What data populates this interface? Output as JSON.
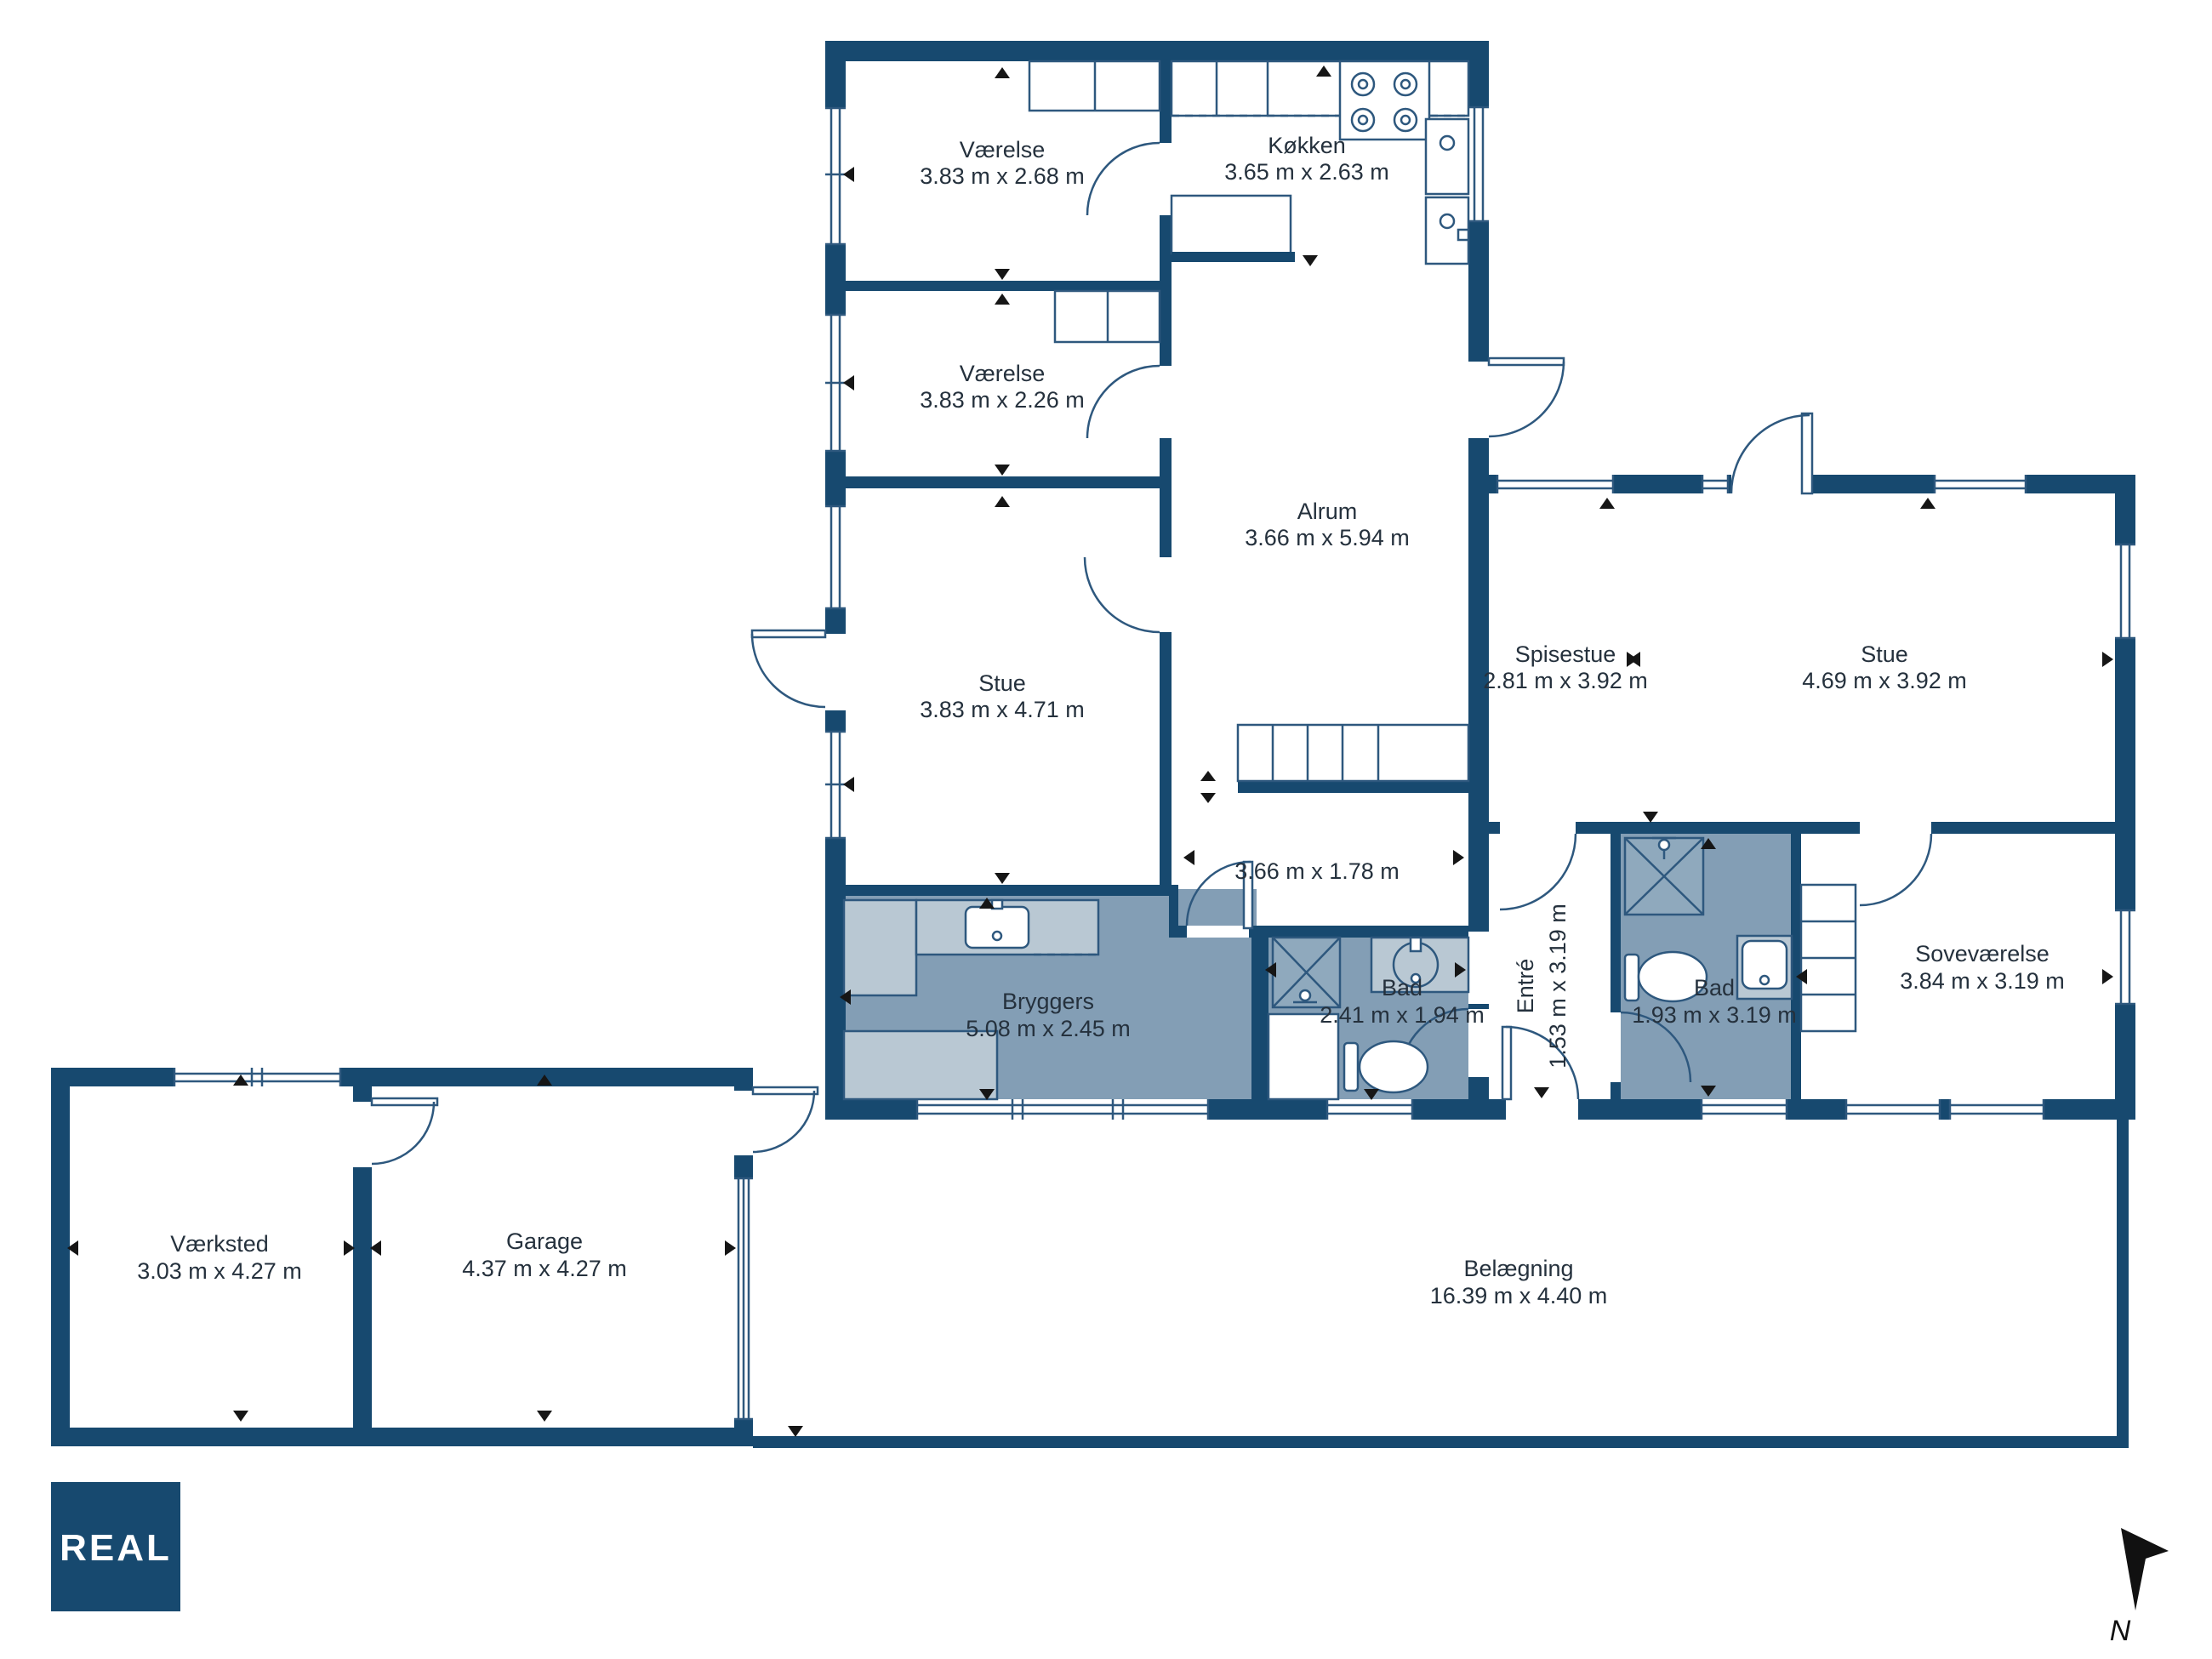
{
  "rooms": [
    {
      "name": "Værelse",
      "dims": "3.83 m x 2.68 m"
    },
    {
      "name": "Værelse",
      "dims": "3.83 m x 2.26 m"
    },
    {
      "name": "Stue",
      "dims": "3.83 m x 4.71 m"
    },
    {
      "name": "Køkken",
      "dims": "3.65 m x 2.63 m"
    },
    {
      "name": "Alrum",
      "dims": "3.66 m x 5.94 m"
    },
    {
      "name": "",
      "dims": "3.66 m x 1.78 m"
    },
    {
      "name": "Spisestue",
      "dims": "2.81 m x 3.92 m"
    },
    {
      "name": "Stue",
      "dims": "4.69 m x 3.92 m"
    },
    {
      "name": "Bryggers",
      "dims": "5.08 m x 2.45 m"
    },
    {
      "name": "Bad",
      "dims": "2.41 m x 1.94 m"
    },
    {
      "name": "Entré",
      "dims": "1.53 m x 3.19 m"
    },
    {
      "name": "Bad",
      "dims": "1.93 m x 3.19 m"
    },
    {
      "name": "Soveværelse",
      "dims": "3.84 m x 3.19 m"
    },
    {
      "name": "Værksted",
      "dims": "3.03 m x 4.27 m"
    },
    {
      "name": "Garage",
      "dims": "4.37 m x 4.27 m"
    },
    {
      "name": "Belægning",
      "dims": "16.39 m x 4.40 m"
    }
  ],
  "branding": {
    "logo_text": "REAL"
  },
  "compass": {
    "label": "N"
  },
  "colors": {
    "wall": "#17496f",
    "wet_room": "#839eb5",
    "line": "#2e587e",
    "text": "#25313d"
  }
}
